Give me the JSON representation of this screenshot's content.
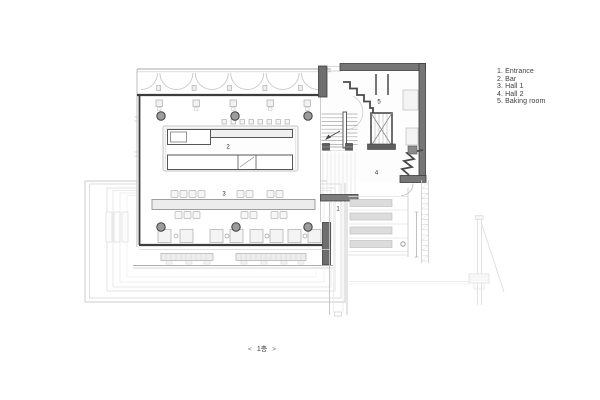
{
  "legend": {
    "items": [
      "1. Entrance",
      "2. Bar",
      "3. Hall 1",
      "4. Hall 2",
      "5. Baking room"
    ]
  },
  "plan": {
    "room_labels": {
      "entrance": "1",
      "bar": "2",
      "hall_1": "3",
      "hall_2": "4",
      "baking_room": "5"
    },
    "colors": {
      "wall_dark": "#3c3c3c",
      "wall_gray": "#767676",
      "line_light": "#c9c9c9",
      "furniture_fill": "#f2f2f2",
      "column_fill": "#9c9c9c"
    }
  },
  "pager": {
    "prev_label": "<",
    "page_label": "1층",
    "next_label": ">"
  }
}
